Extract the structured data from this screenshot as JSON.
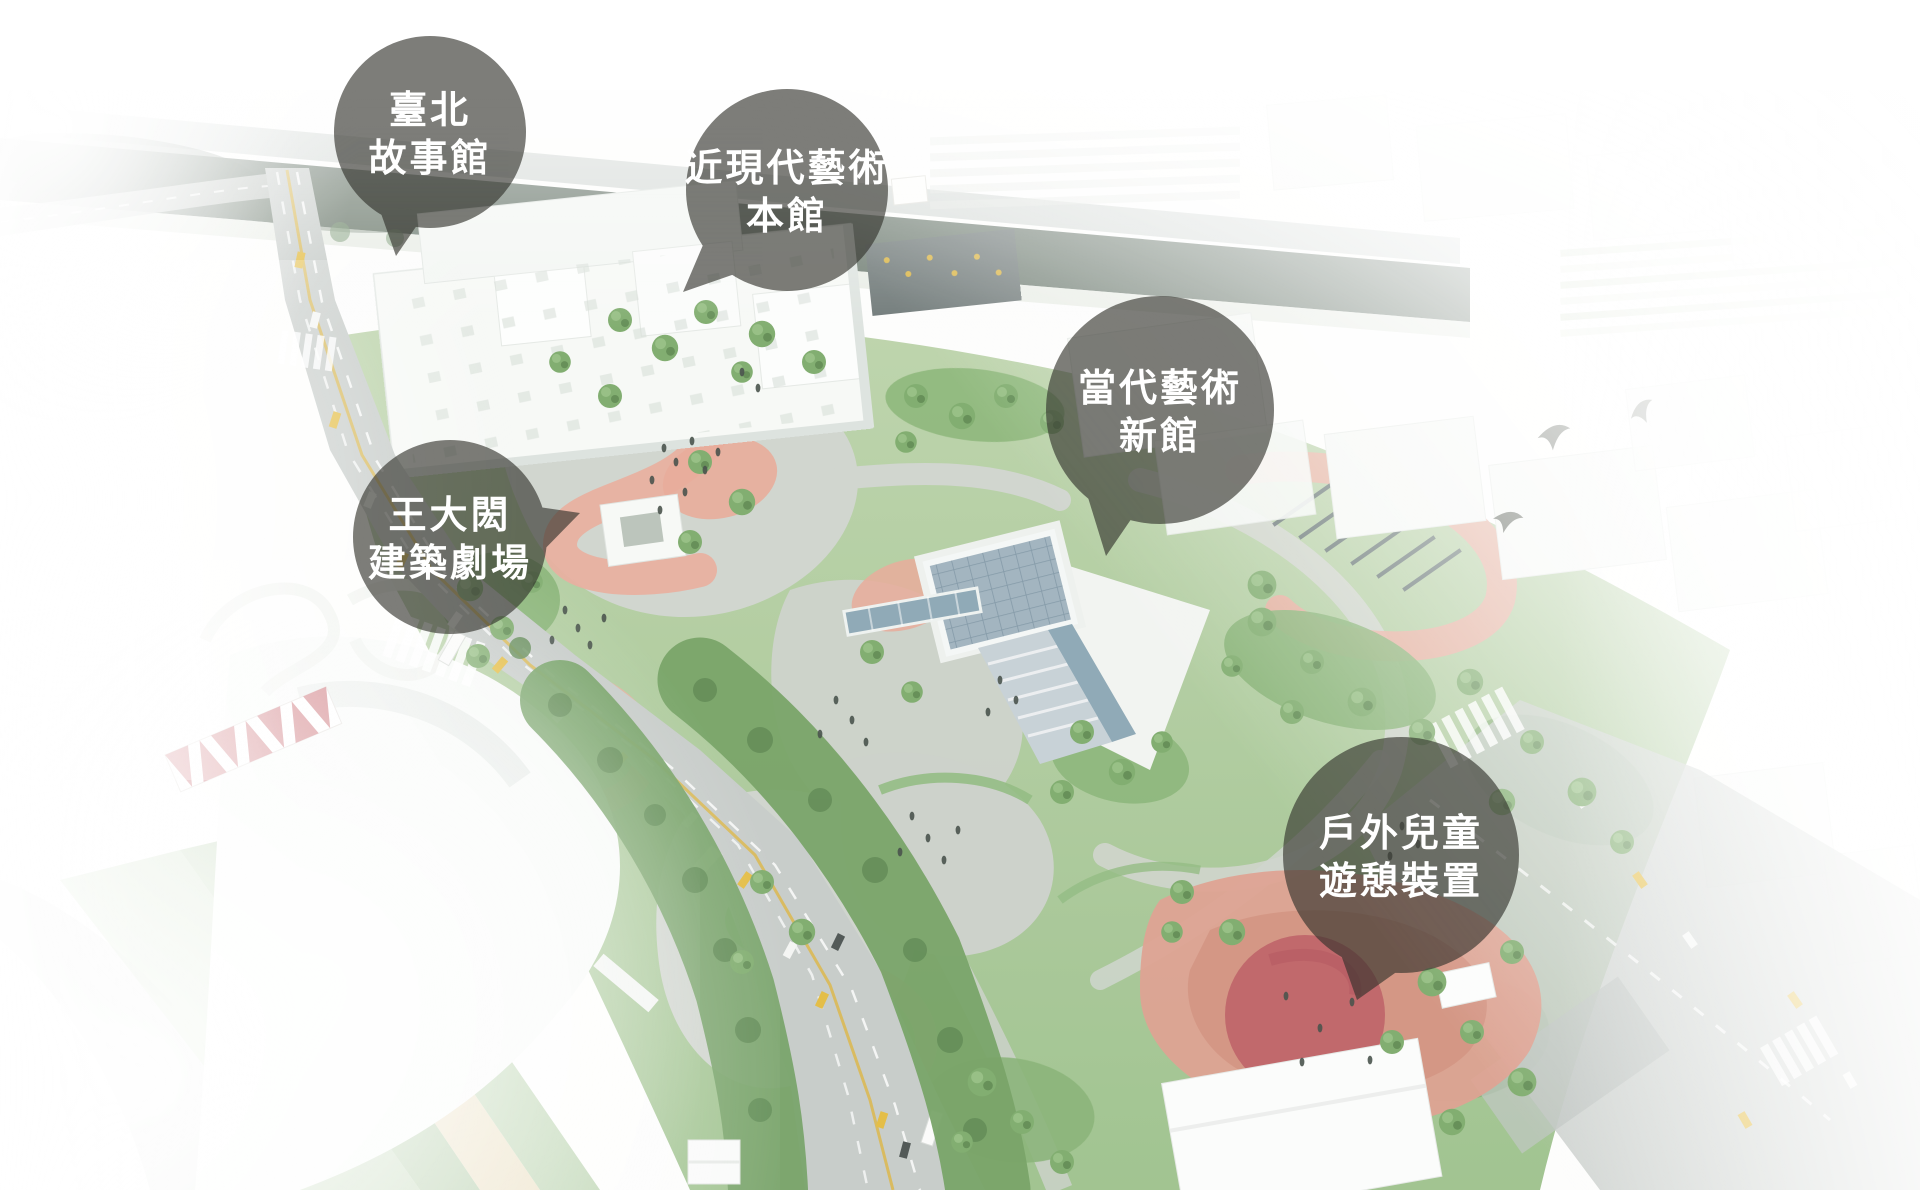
{
  "callouts": [
    {
      "id": "taipei-story-house",
      "line1": "臺北",
      "line2": "故事館"
    },
    {
      "id": "modern-art-main-hall",
      "line1": "近現代藝術",
      "line2": "本館"
    },
    {
      "id": "contemporary-art-new-hall",
      "line1": "當代藝術",
      "line2": "新館"
    },
    {
      "id": "wang-da-hong-architecture-theatre",
      "line1": "王大閎",
      "line2": "建築劇場"
    },
    {
      "id": "outdoor-children-play-area",
      "line1": "戶外兒童",
      "line2": "遊憩裝置"
    }
  ],
  "colors": {
    "bubble_fill": "#31312b",
    "bubble_opacity": "0.63",
    "label_text": "#ffffff",
    "park_green": "#9dc18c",
    "tree_green": "#6f9a63",
    "path_pink": "#e8ab9b",
    "playground_terracotta": "#dd9f8e",
    "playground_red": "#bd5f64",
    "road_gray": "#c6cbc8",
    "river_green": "#5e6e62",
    "water_blue": "#8ba6b4",
    "building_white": "#f7f9f6",
    "taxi_yellow": "#e3bb3f"
  }
}
